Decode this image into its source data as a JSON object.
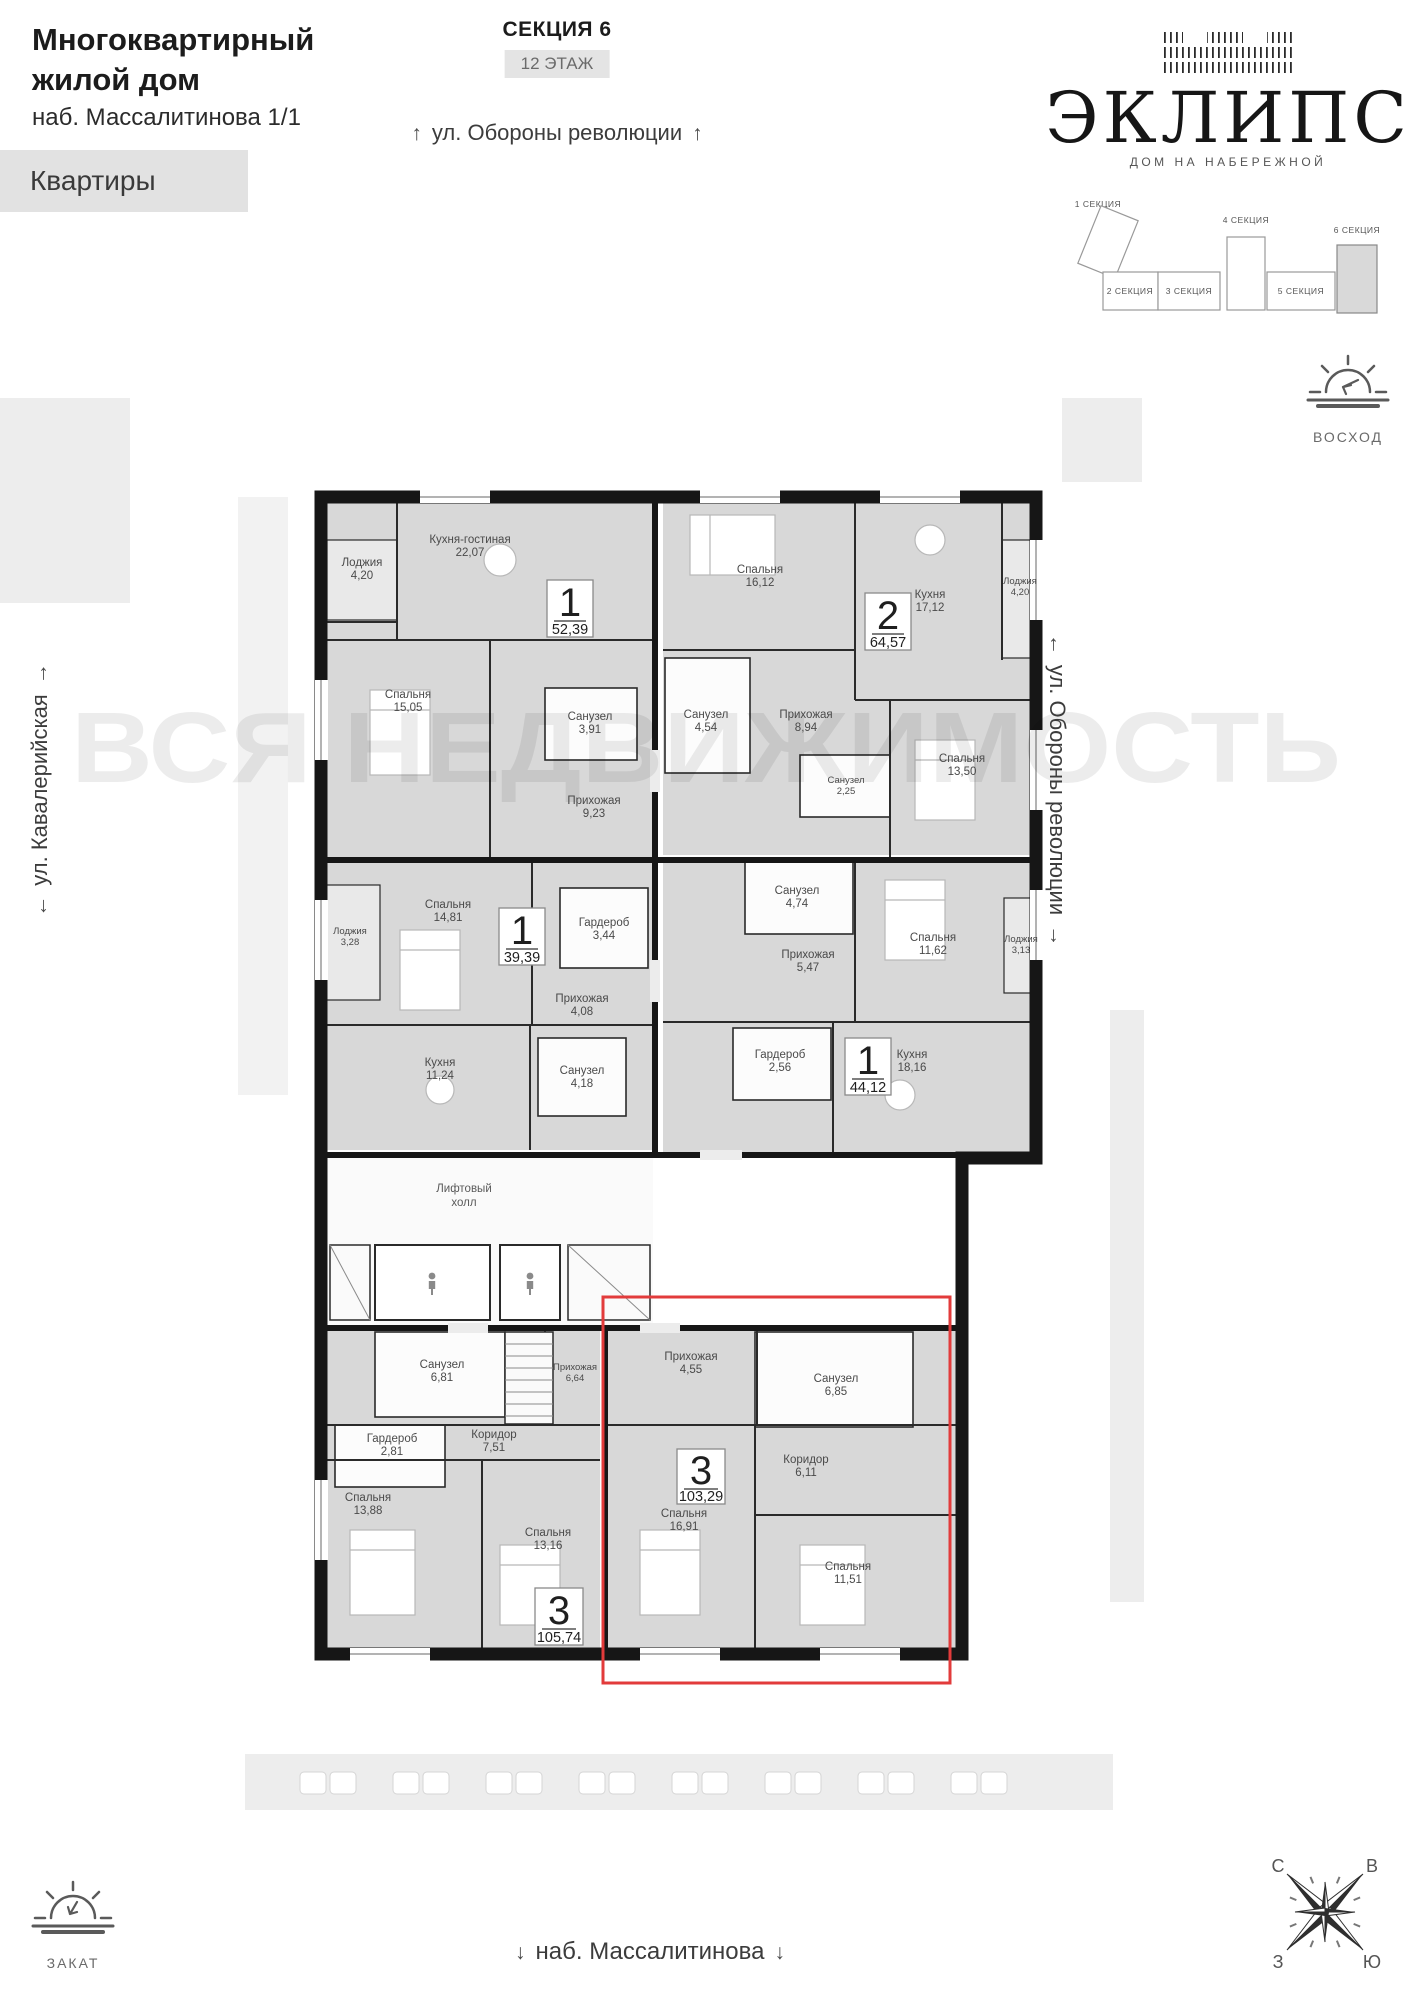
{
  "header": {
    "title_line1": "Многоквартирный",
    "title_line2": "жилой дом",
    "address": "наб. Массалитинова 1/1",
    "apartments_label": "Квартиры",
    "section_label": "СЕКЦИЯ 6",
    "floor_label": "12 ЭТАЖ"
  },
  "logo": {
    "name": "ЭКЛИПС",
    "tagline": "ДОМ НА НАБЕРЕЖНОЙ"
  },
  "sections_diagram": [
    {
      "label": "1 СЕКЦИЯ"
    },
    {
      "label": "2 СЕКЦИЯ"
    },
    {
      "label": "3 СЕКЦИЯ"
    },
    {
      "label": "4 СЕКЦИЯ"
    },
    {
      "label": "5 СЕКЦИЯ"
    },
    {
      "label": "6 СЕКЦИЯ"
    }
  ],
  "streets": {
    "top": "ул. Обороны революции",
    "left": "ул. Кавалерийская",
    "right": "ул. Обороны революции",
    "bottom": "наб. Массалитинова"
  },
  "icons": {
    "up": "↑",
    "down": "↓",
    "left": "←",
    "right": "→"
  },
  "orientation": {
    "sunrise": "ВОСХОД",
    "sunset": "ЗАКАТ",
    "compass": {
      "n": "С",
      "e": "В",
      "w": "З",
      "s": "Ю"
    }
  },
  "watermark": "ВСЯ НЕДВИЖИМОСТЬ",
  "common": {
    "lift_line1": "Лифтовый",
    "lift_line2": "холл"
  },
  "apartments": [
    {
      "number": "1",
      "area": "52,39",
      "rooms": [
        {
          "name": "Лоджия",
          "area": "4,20"
        },
        {
          "name": "Кухня-гостиная",
          "area": "22,07"
        },
        {
          "name": "Спальня",
          "area": "15,05"
        },
        {
          "name": "Санузел",
          "area": "3,91"
        },
        {
          "name": "Прихожая",
          "area": "9,23"
        }
      ]
    },
    {
      "number": "2",
      "area": "64,57",
      "rooms": [
        {
          "name": "Спальня",
          "area": "16,12"
        },
        {
          "name": "Кухня",
          "area": "17,12"
        },
        {
          "name": "Лоджия",
          "area": "4,20"
        },
        {
          "name": "Санузел",
          "area": "4,54"
        },
        {
          "name": "Прихожая",
          "area": "8,94"
        },
        {
          "name": "Санузел",
          "area": "2,25"
        },
        {
          "name": "Спальня",
          "area": "13,50"
        }
      ]
    },
    {
      "number": "1",
      "area": "39,39",
      "rooms": [
        {
          "name": "Спальня",
          "area": "14,81"
        },
        {
          "name": "Лоджия",
          "area": "3,28"
        },
        {
          "name": "Гардероб",
          "area": "3,44"
        },
        {
          "name": "Прихожая",
          "area": "4,08"
        },
        {
          "name": "Кухня",
          "area": "11,24"
        },
        {
          "name": "Санузел",
          "area": "4,18"
        }
      ]
    },
    {
      "number": "1",
      "area": "44,12",
      "rooms": [
        {
          "name": "Санузел",
          "area": "4,74"
        },
        {
          "name": "Прихожая",
          "area": "5,47"
        },
        {
          "name": "Спальня",
          "area": "11,62"
        },
        {
          "name": "Лоджия",
          "area": "3,13"
        },
        {
          "name": "Гардероб",
          "area": "2,56"
        },
        {
          "name": "Кухня",
          "area": "18,16"
        }
      ]
    },
    {
      "number": "3",
      "area": "105,74",
      "rooms": [
        {
          "name": "Санузел",
          "area": "6,81"
        },
        {
          "name": "Прихожая",
          "area": "6,64"
        },
        {
          "name": "Гардероб",
          "area": "2,81"
        },
        {
          "name": "Коридор",
          "area": "7,51"
        },
        {
          "name": "Спальня",
          "area": "13,88"
        },
        {
          "name": "Спальня",
          "area": "13,16"
        }
      ]
    },
    {
      "number": "3",
      "area": "103,29",
      "rooms": [
        {
          "name": "Прихожая",
          "area": "4,55"
        },
        {
          "name": "Санузел",
          "area": "6,85"
        },
        {
          "name": "Коридор",
          "area": "6,11"
        },
        {
          "name": "Спальня",
          "area": "16,91"
        },
        {
          "name": "Спальня",
          "area": "11,51"
        }
      ]
    }
  ]
}
